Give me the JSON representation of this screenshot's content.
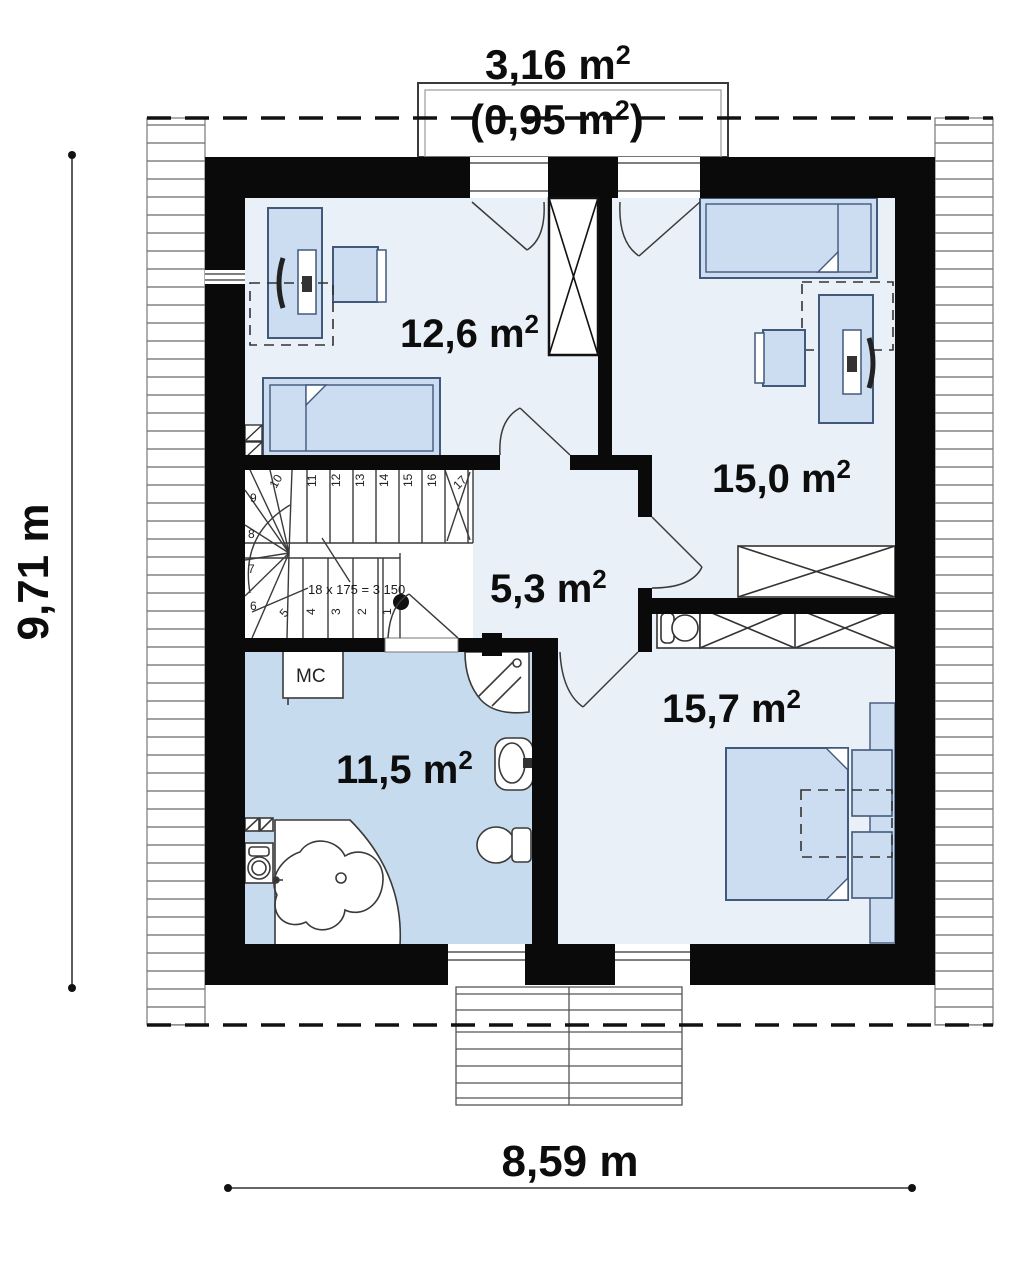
{
  "colors": {
    "wall": "#0a0a0a",
    "room_fill": "#e9f0f8",
    "bathroom_fill": "#c7dbee",
    "furniture_fill": "#cdddf1",
    "furniture_stroke": "#41597a",
    "line": "#444444"
  },
  "balcony": {
    "area_gross": "3,16 m",
    "area_net_open": "(0,95 m",
    "sup": "2",
    "close_paren": ")"
  },
  "rooms": [
    {
      "name": "bedroom-top-left",
      "area": "12,6 m",
      "sup": "2"
    },
    {
      "name": "bedroom-top-right",
      "area": "15,0 m",
      "sup": "2"
    },
    {
      "name": "hall",
      "area": "5,3 m",
      "sup": "2"
    },
    {
      "name": "bathroom",
      "area": "11,5 m",
      "sup": "2"
    },
    {
      "name": "bedroom-bottom-right",
      "area": "15,7 m",
      "sup": "2"
    }
  ],
  "dimensions": {
    "height_left": "9,71 m",
    "width_bottom": "8,59 m"
  },
  "stairs": {
    "note": "18 x 175 = 3 150",
    "numbers": [
      "1",
      "2",
      "3",
      "4",
      "5",
      "6",
      "7",
      "8",
      "9",
      "10",
      "11",
      "12",
      "13",
      "14",
      "15",
      "16",
      "17"
    ]
  },
  "labels": {
    "closet": "MC"
  }
}
